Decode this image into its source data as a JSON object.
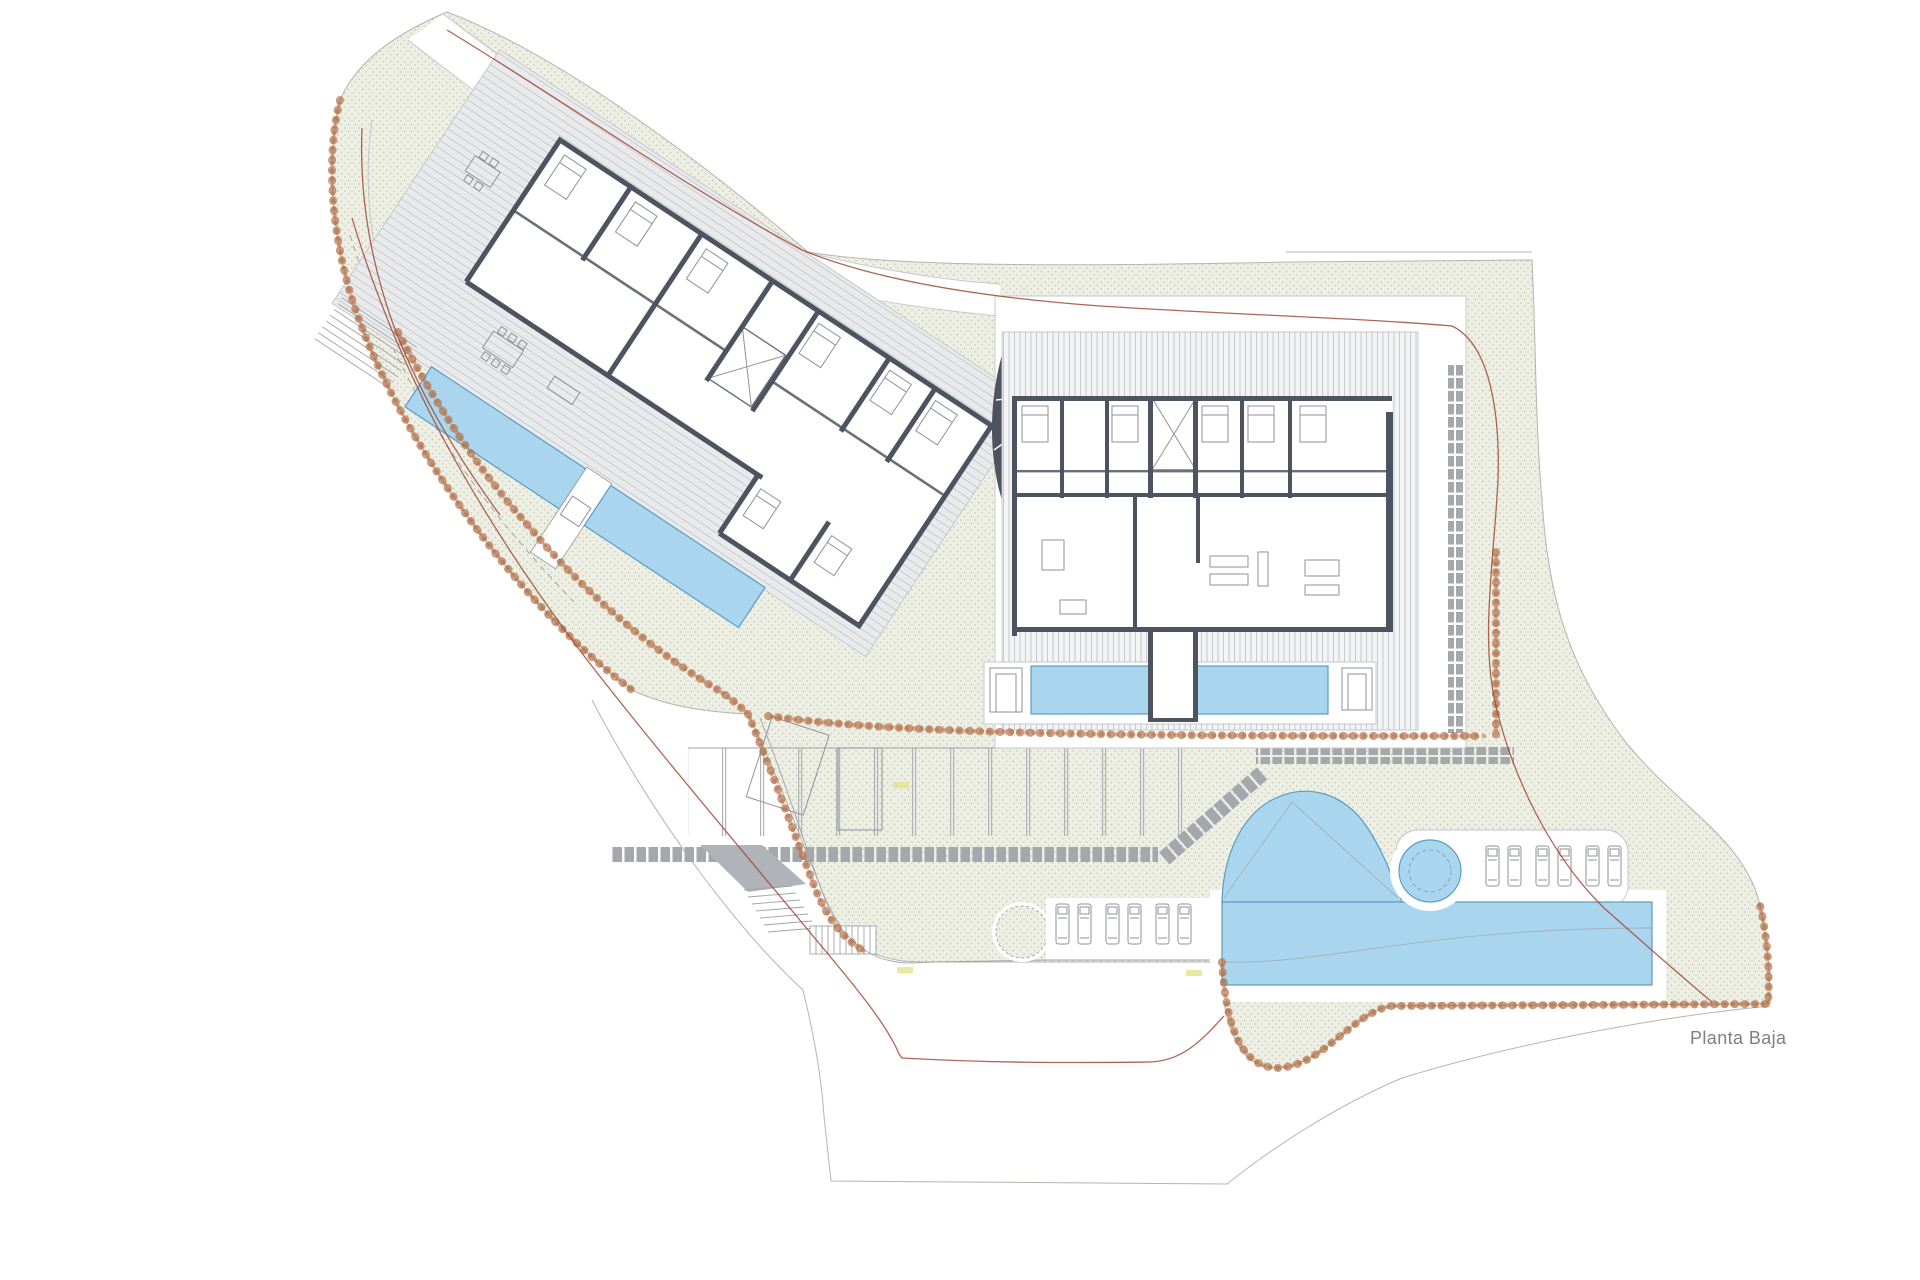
{
  "plan": {
    "title": "Planta Baja"
  },
  "colors": {
    "paper": "#ffffff",
    "green_fill": "#edeee4",
    "green_dot": "#c9cdb4",
    "wall": "#4d5460",
    "pool": "#a9d5ee",
    "pool_edge": "#5c9cc0",
    "pebble": "#b5724a",
    "red_line": "#a14a35",
    "tile": "#a4a7ac",
    "deck_line": "#c7c9cd",
    "terrace_fill": "#e9eaec",
    "terrace_line": "#c6c8cc",
    "boundary": "#b9b3ad",
    "thin_line": "#9fa3a8",
    "title_text": "#7f7f7f",
    "elevation_mark": "#e3e388"
  },
  "features": {
    "site": "landscaped residential ground-floor site plan",
    "left_building": "rotated apartment block with terraces and two linear pools",
    "right_building": "apartment block with wood deck and two linear pools",
    "pools": [
      "linear-pool-left-1",
      "linear-pool-left-2",
      "linear-pool-right-1",
      "linear-pool-right-2",
      "main-organic-pool",
      "spa-circle"
    ],
    "amenities": [
      "parking-stalls",
      "sun-loungers",
      "tree-planter",
      "stepping-stone-paths",
      "garden-stairs",
      "pebble-borders"
    ]
  }
}
